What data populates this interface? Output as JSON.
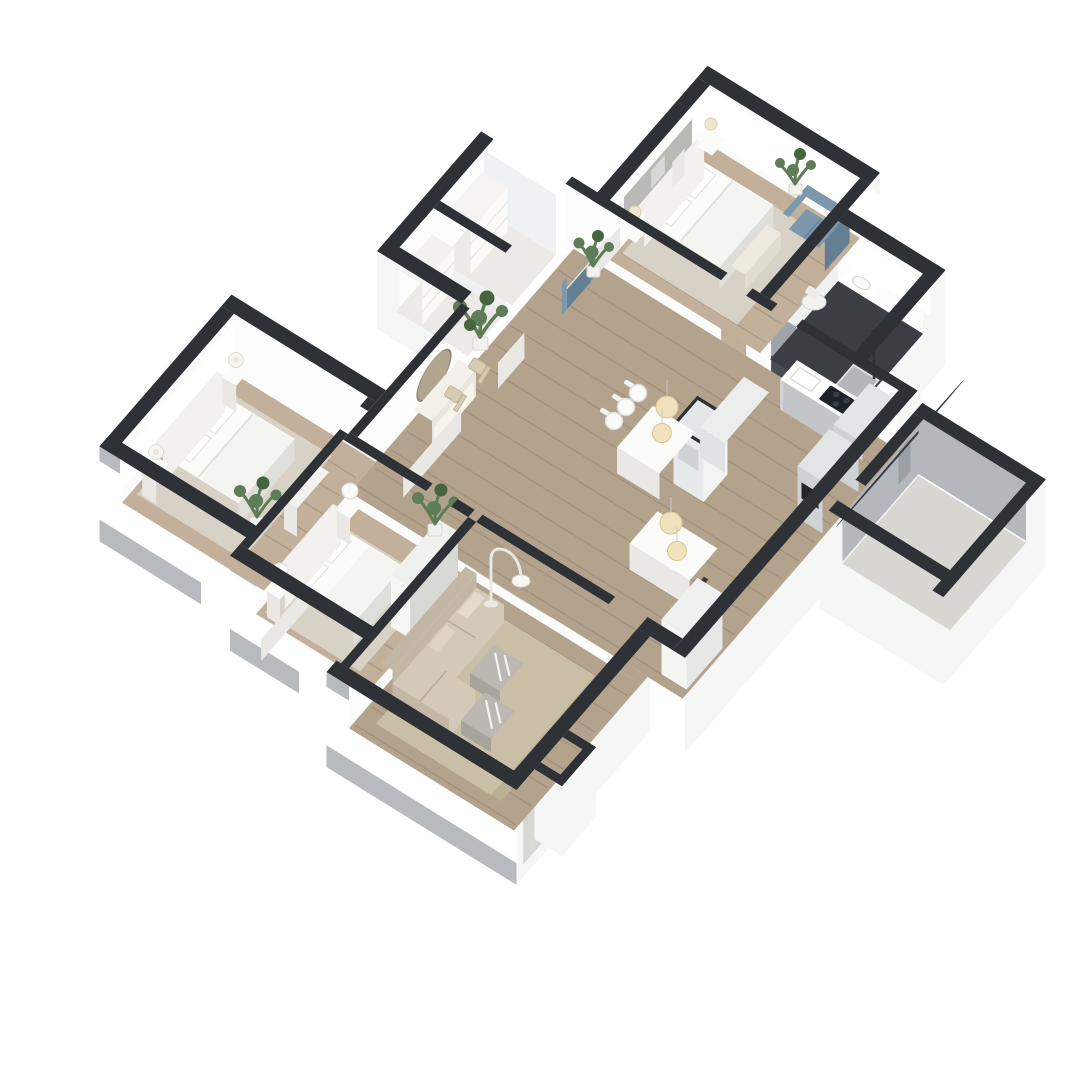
{
  "scene": {
    "description": "3D isometric floor plan rendering of a furnished apartment, viewed from above at an angle, on a white background",
    "rooms": [
      {
        "name": "bedroom-top",
        "furniture": [
          "double-bed",
          "headboard",
          "two-nightstands",
          "table-lamps",
          "foot-bench",
          "blue-loveseat",
          "potted-plant",
          "wall-picture",
          "windows"
        ]
      },
      {
        "name": "bathroom",
        "furniture": [
          "vanity-sink",
          "wall-mirror",
          "toilet",
          "shower",
          "dark-tile-floor"
        ]
      },
      {
        "name": "hallway",
        "furniture": [
          "console-table",
          "oval-wall-mirror",
          "two-wood-chairs",
          "two-potted-plants"
        ]
      },
      {
        "name": "closets",
        "furniture": [
          "shelf-cabinet",
          "storage-cabinet"
        ]
      },
      {
        "name": "kitchen",
        "furniture": [
          "cabinet-run",
          "cooktop",
          "tall-cabinets",
          "island-partition",
          "bar-table",
          "three-stools",
          "pendant-lights",
          "tall-white-cabinet"
        ]
      },
      {
        "name": "dining",
        "furniture": [
          "white-table",
          "pendant-lights"
        ]
      },
      {
        "name": "bedroom-master",
        "furniture": [
          "double-bed",
          "headboard",
          "two-nightstands",
          "round-lamps",
          "dresser",
          "potted-plant",
          "windows"
        ]
      },
      {
        "name": "bedroom-middle",
        "furniture": [
          "double-bed",
          "headboard",
          "two-nightstands",
          "flower-lamps",
          "wardrobe",
          "potted-plant",
          "windows"
        ]
      },
      {
        "name": "living-room",
        "furniture": [
          "beige-sectional-sofa",
          "patterned-rug",
          "two-marble-coffee-tables",
          "arc-floor-lamp",
          "oval-leaning-mirror",
          "entry-door"
        ]
      },
      {
        "name": "empty-side-room",
        "furniture": []
      }
    ]
  },
  "colors": {
    "wallTop": "#2e3135",
    "interiorFace": "#fcfcfc",
    "interiorFaceShade": "#f0f1f2",
    "facadeLight": "#f5f6f6",
    "facadeGray": "#b7babe",
    "garageWall": "#b4b8bd",
    "woodMain": "#b3a28c",
    "woodBedroom": "#c2b09a",
    "plankLine": "#8a7a63",
    "bathFloor": "#3b3e43",
    "garageFloor": "#d8d6d1",
    "closetFloor": "#eceae6",
    "rugBedroom": "#d8d2c6",
    "rugLiving": "#c9bfa6",
    "rugPatternDot": "#a99d80",
    "furnitureWhite": "#fbfbfa",
    "furnitureShade": "#e9e8e5",
    "furnitureShadeDark": "#dededb",
    "headboard": "#f2f1ef",
    "sofaBlue": "#7d98ac",
    "sofaBlueDark": "#657f92",
    "sofaBeige": "#d3c9b8",
    "sofaBeigeDark": "#c2b7a4",
    "kitchenCabinet": "#d5d7d8",
    "kitchenTall": "#cfd2d4",
    "cooktopBlack": "#1f2226",
    "counterWhite": "#fdfdfc",
    "pendantCream": "#efe2bd",
    "pendantTrim": "#d9c691",
    "plantGreen": "#5e7c55",
    "plantGreenDark": "#46643f",
    "potWhite": "#f2f1ee",
    "woodChair": "#d9cbb2",
    "marbleTable": "#bcb8b1",
    "marbleTableDark": "#a8a49d",
    "windowGlass": "#eef1f2",
    "windowFrame": "#ffffff",
    "mirrorTan": "#b2a58e",
    "lampWhite": "#f6f5f2",
    "background": "#ffffff"
  }
}
